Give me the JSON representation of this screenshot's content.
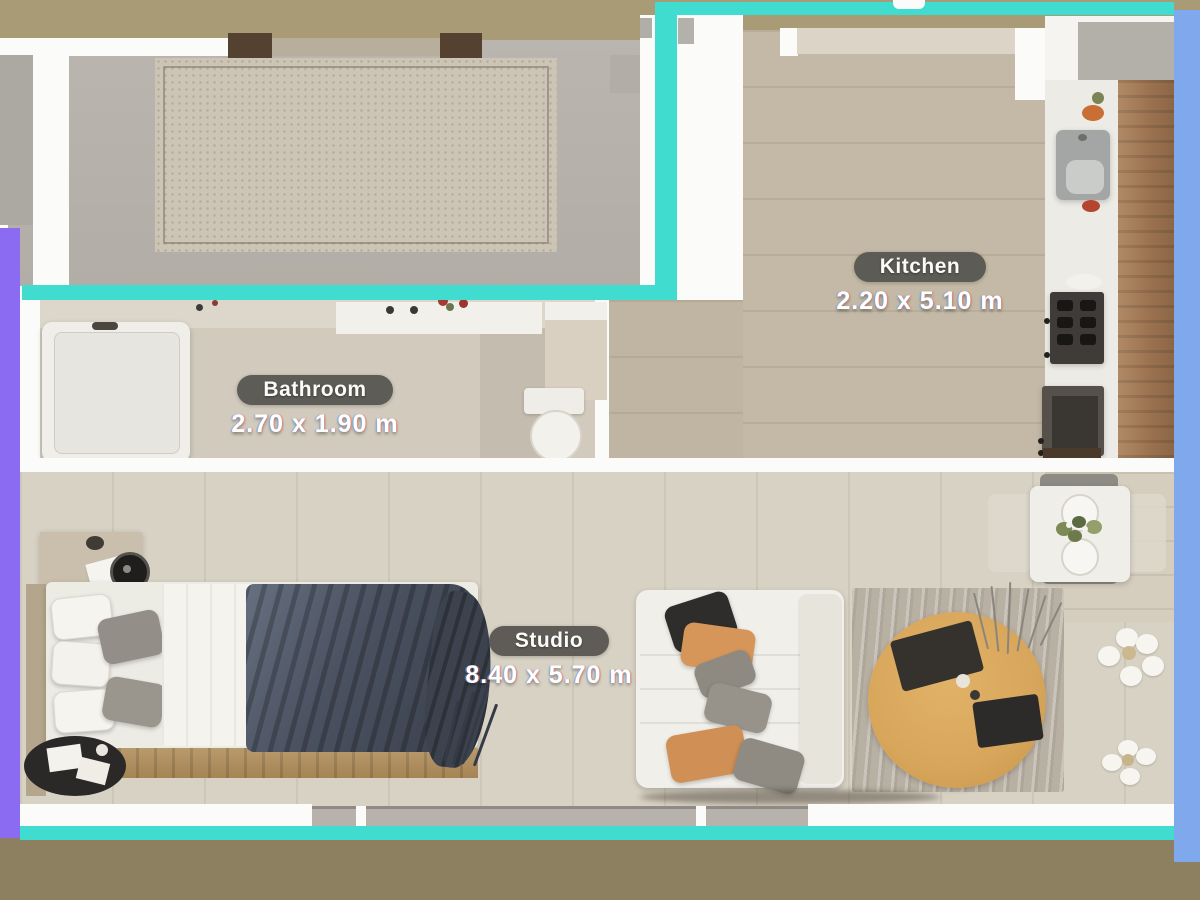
{
  "plan": {
    "rooms": [
      {
        "name": "Kitchen",
        "dimensions": "2.20 x 5.10 m"
      },
      {
        "name": "Bathroom",
        "dimensions": "2.70 x 1.90 m"
      },
      {
        "name": "Studio",
        "dimensions": "8.40 x 5.70 m"
      }
    ],
    "colors": {
      "wall_highlight_teal": "#3FDCCF",
      "left_strip_purple": "#8A6BF2",
      "right_strip_blue": "#7FA9EC",
      "label_pill_background": "#56544F",
      "label_text": "#FFFFFF"
    },
    "furniture": [
      "terrace-mat",
      "bathtub",
      "vanity-sink",
      "toilet",
      "shower-cabinet",
      "kitchen-sink",
      "stove",
      "oven-cabinet",
      "kitchen-counter",
      "dining-table",
      "dining-chairs",
      "bed",
      "nightstand",
      "record-player",
      "round-rug",
      "sofa",
      "throw-pillows",
      "coffee-table",
      "area-rug",
      "floor-plant",
      "white-flowers"
    ]
  }
}
